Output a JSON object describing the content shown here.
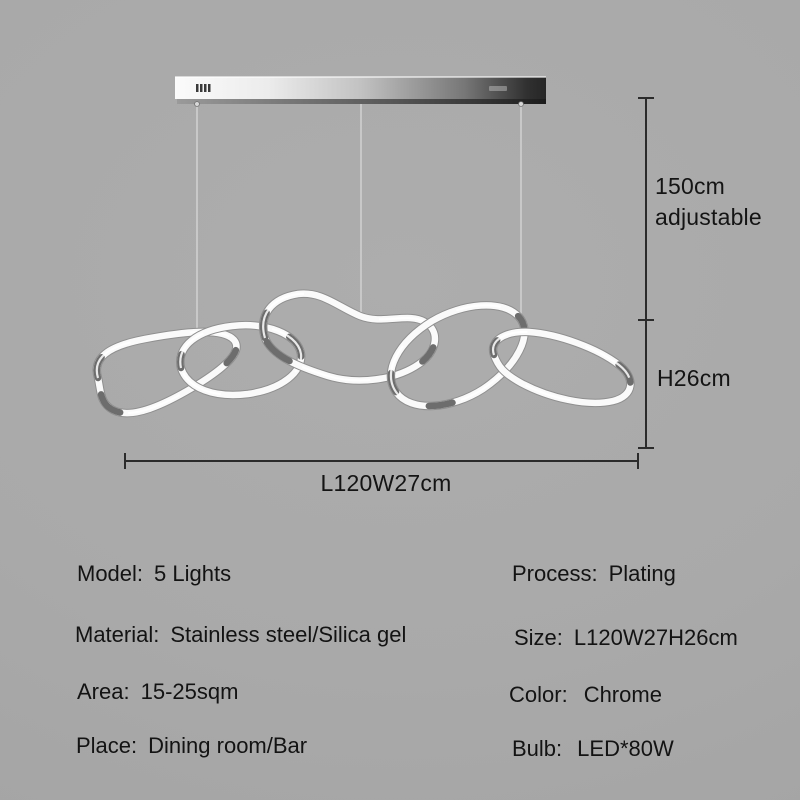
{
  "image_type": "product-specification-diagram",
  "dimensions": {
    "drop_line1": "150cm",
    "drop_line2": "adjustable",
    "height": "H26cm",
    "width": "L120W27cm"
  },
  "specs": {
    "left": [
      {
        "label": "Model:",
        "value": "5 Lights"
      },
      {
        "label": "Material:",
        "value": "Stainless steel/Silica gel"
      },
      {
        "label": "Area:",
        "value": "15-25sqm"
      },
      {
        "label": "Place:",
        "value": "Dining room/Bar"
      }
    ],
    "right": [
      {
        "label": "Process:",
        "value": "Plating"
      },
      {
        "label": "Size:",
        "value": "L120W27H26cm"
      },
      {
        "label": "Color:",
        "value": "Chrome"
      },
      {
        "label": "Bulb:",
        "value": "LED*80W"
      }
    ]
  },
  "colors": {
    "background": "#a9a9a9",
    "text": "#141414",
    "dimension_lines": "#2b2b2b",
    "chrome_light": "#fafafa",
    "chrome_dark": "#4a4a4a"
  },
  "icons": {
    "ceiling_bar": "chrome-canopy-bar",
    "rings_count": 5
  }
}
